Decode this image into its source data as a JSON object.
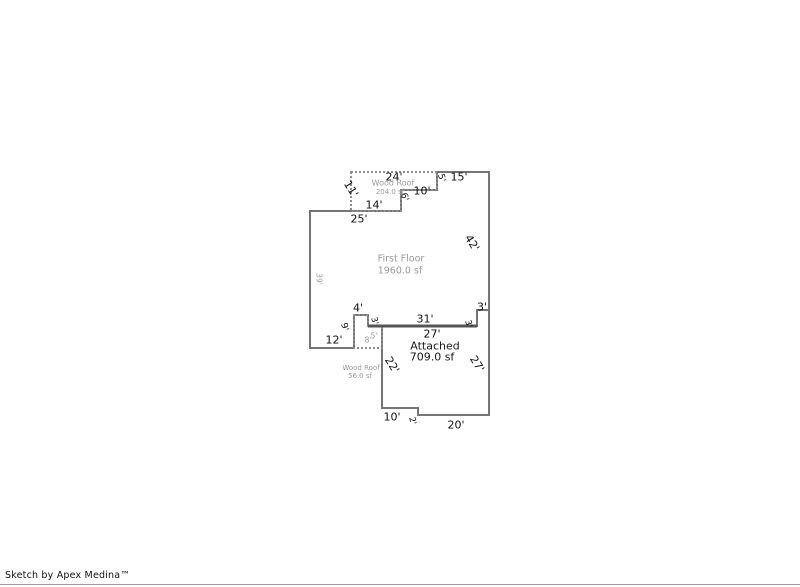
{
  "footer": {
    "credit": "Sketch by Apex Medina™"
  },
  "colors": {
    "wall": "#757575",
    "wall_heavy": "#555555",
    "roof_dash": "#8c8c8c",
    "dim": "#111111",
    "area_gray": "#9a9a9a",
    "area_black": "#1a1a1a"
  },
  "sketch": {
    "areas": [
      {
        "name": "first-floor",
        "label": "First Floor",
        "size": "1960.0 sf"
      },
      {
        "name": "attached",
        "label": "Attached",
        "size": "709.0 sf"
      },
      {
        "name": "wood-roof-upper",
        "label": "Wood Roof",
        "size": "204.0 sf"
      },
      {
        "name": "wood-roof-lower",
        "label": "Wood Roof",
        "size": "56.0 sf"
      }
    ],
    "outlines": [
      {
        "name": "first-floor-outline",
        "points": "310,211 401,211 401,190 437,190 437,172 489,172 489,310 477,310 477,326 368,326 368,315 354,315 354,348 310,348",
        "stroke": "wall",
        "width": 2,
        "dashed": false
      },
      {
        "name": "attached-outline",
        "points": "382,326 477,326 477,310 489,310 489,415 418,415 418,408 382,408",
        "stroke": "wall",
        "width": 2,
        "dashed": false
      },
      {
        "name": "wood-roof-upper-outline",
        "points": "351,172 437,172 437,190 401,190 401,211 351,211",
        "stroke": "roof_dash",
        "width": 2,
        "dashed": true
      },
      {
        "name": "wood-roof-lower-outline",
        "points": "354,315 368,315 368,326 382,326 382,348 354,348",
        "stroke": "roof_dash",
        "width": 2,
        "dashed": true
      }
    ],
    "lines": [
      {
        "name": "shared-wall-line",
        "x1": 368,
        "y1": 326,
        "x2": 477,
        "y2": 326,
        "stroke": "wall_heavy",
        "width": 3
      }
    ],
    "labels": [
      {
        "name": "dim-top-24",
        "text": "24'",
        "x": 394,
        "y": 177,
        "rot": 0,
        "size": 11,
        "color": "dim"
      },
      {
        "name": "dim-top-15",
        "text": "15'",
        "x": 459,
        "y": 177,
        "rot": 0,
        "size": 11,
        "color": "dim"
      },
      {
        "name": "dim-step-5",
        "text": "5'",
        "x": 441,
        "y": 178,
        "rot": 75,
        "size": 9,
        "color": "dim"
      },
      {
        "name": "dim-step-10",
        "text": "10'",
        "x": 422,
        "y": 191,
        "rot": 0,
        "size": 11,
        "color": "dim"
      },
      {
        "name": "dim-step-6",
        "text": "6'",
        "x": 404,
        "y": 197,
        "rot": 75,
        "size": 9,
        "color": "dim"
      },
      {
        "name": "dim-roof-14",
        "text": "14'",
        "x": 374,
        "y": 205,
        "rot": 0,
        "size": 11,
        "color": "dim"
      },
      {
        "name": "dim-roof-11",
        "text": "11'",
        "x": 351,
        "y": 189,
        "rot": 58,
        "size": 11,
        "color": "dim"
      },
      {
        "name": "dim-top-25",
        "text": "25'",
        "x": 359,
        "y": 219,
        "rot": 0,
        "size": 11,
        "color": "dim"
      },
      {
        "name": "dim-right-42",
        "text": "42'",
        "x": 472,
        "y": 243,
        "rot": 58,
        "size": 11,
        "color": "dim"
      },
      {
        "name": "dim-left-39",
        "text": "39'",
        "x": 319,
        "y": 279,
        "rot": 90,
        "size": 7.5,
        "color": "area_gray"
      },
      {
        "name": "dim-notch-4",
        "text": "4'",
        "x": 358,
        "y": 308,
        "rot": 0,
        "size": 11,
        "color": "dim"
      },
      {
        "name": "dim-notch-3",
        "text": "3'",
        "x": 374,
        "y": 321,
        "rot": 75,
        "size": 8.5,
        "color": "dim"
      },
      {
        "name": "dim-notch-9",
        "text": "9'",
        "x": 344,
        "y": 327,
        "rot": 75,
        "size": 9,
        "color": "dim"
      },
      {
        "name": "dim-bottom-12",
        "text": "12'",
        "x": 334,
        "y": 340,
        "rot": 0,
        "size": 11,
        "color": "dim"
      },
      {
        "name": "dim-roof-8",
        "text": "8'",
        "x": 368,
        "y": 340,
        "rot": 0,
        "size": 7.5,
        "color": "area_gray"
      },
      {
        "name": "dim-roof-5",
        "text": "5'",
        "x": 374,
        "y": 336,
        "rot": 0,
        "size": 7.5,
        "color": "area_gray"
      },
      {
        "name": "dim-shared-31",
        "text": "31'",
        "x": 425,
        "y": 319,
        "rot": 0,
        "size": 11,
        "color": "dim"
      },
      {
        "name": "dim-shared-27",
        "text": "27'",
        "x": 432,
        "y": 334,
        "rot": 0,
        "size": 11,
        "color": "dim"
      },
      {
        "name": "dim-rightstep-3h",
        "text": "3'",
        "x": 482,
        "y": 307,
        "rot": 0,
        "size": 11,
        "color": "dim"
      },
      {
        "name": "dim-rightstep-3v",
        "text": "3'",
        "x": 468,
        "y": 324,
        "rot": 75,
        "size": 8.5,
        "color": "dim"
      },
      {
        "name": "dim-attached-22",
        "text": "22'",
        "x": 392,
        "y": 365,
        "rot": 58,
        "size": 11,
        "color": "dim"
      },
      {
        "name": "dim-attached-27",
        "text": "27'",
        "x": 477,
        "y": 364,
        "rot": 58,
        "size": 11,
        "color": "dim"
      },
      {
        "name": "dim-bottom-10",
        "text": "10'",
        "x": 392,
        "y": 417,
        "rot": 0,
        "size": 11,
        "color": "dim"
      },
      {
        "name": "dim-bottom-2",
        "text": "2'",
        "x": 412,
        "y": 421,
        "rot": 75,
        "size": 8.5,
        "color": "dim"
      },
      {
        "name": "dim-bottom-20",
        "text": "20'",
        "x": 456,
        "y": 425,
        "rot": 0,
        "size": 11,
        "color": "dim"
      },
      {
        "name": "area-label-wood-roof-upper",
        "text": "Wood Roof",
        "x": 393,
        "y": 183,
        "rot": 0,
        "size": 8,
        "color": "area_gray"
      },
      {
        "name": "area-size-wood-roof-upper",
        "text": "204.0 sf",
        "x": 390,
        "y": 192,
        "rot": 0,
        "size": 7,
        "color": "area_gray"
      },
      {
        "name": "area-label-first-floor",
        "text": "First Floor",
        "x": 401,
        "y": 259,
        "rot": 0,
        "size": 9.5,
        "color": "area_gray"
      },
      {
        "name": "area-size-first-floor",
        "text": "1960.0 sf",
        "x": 400,
        "y": 271,
        "rot": 0,
        "size": 9.5,
        "color": "area_gray"
      },
      {
        "name": "area-label-attached",
        "text": "Attached",
        "x": 435,
        "y": 346,
        "rot": 0,
        "size": 11,
        "color": "area_black"
      },
      {
        "name": "area-size-attached",
        "text": "709.0 sf",
        "x": 432,
        "y": 357,
        "rot": 0,
        "size": 11,
        "color": "area_black"
      },
      {
        "name": "area-label-wood-roof-lower",
        "text": "Wood Roof",
        "x": 361,
        "y": 368,
        "rot": 0,
        "size": 7,
        "color": "area_gray"
      },
      {
        "name": "area-size-wood-roof-lower",
        "text": "56.0 sf",
        "x": 360,
        "y": 376,
        "rot": 0,
        "size": 7,
        "color": "area_gray"
      }
    ]
  }
}
